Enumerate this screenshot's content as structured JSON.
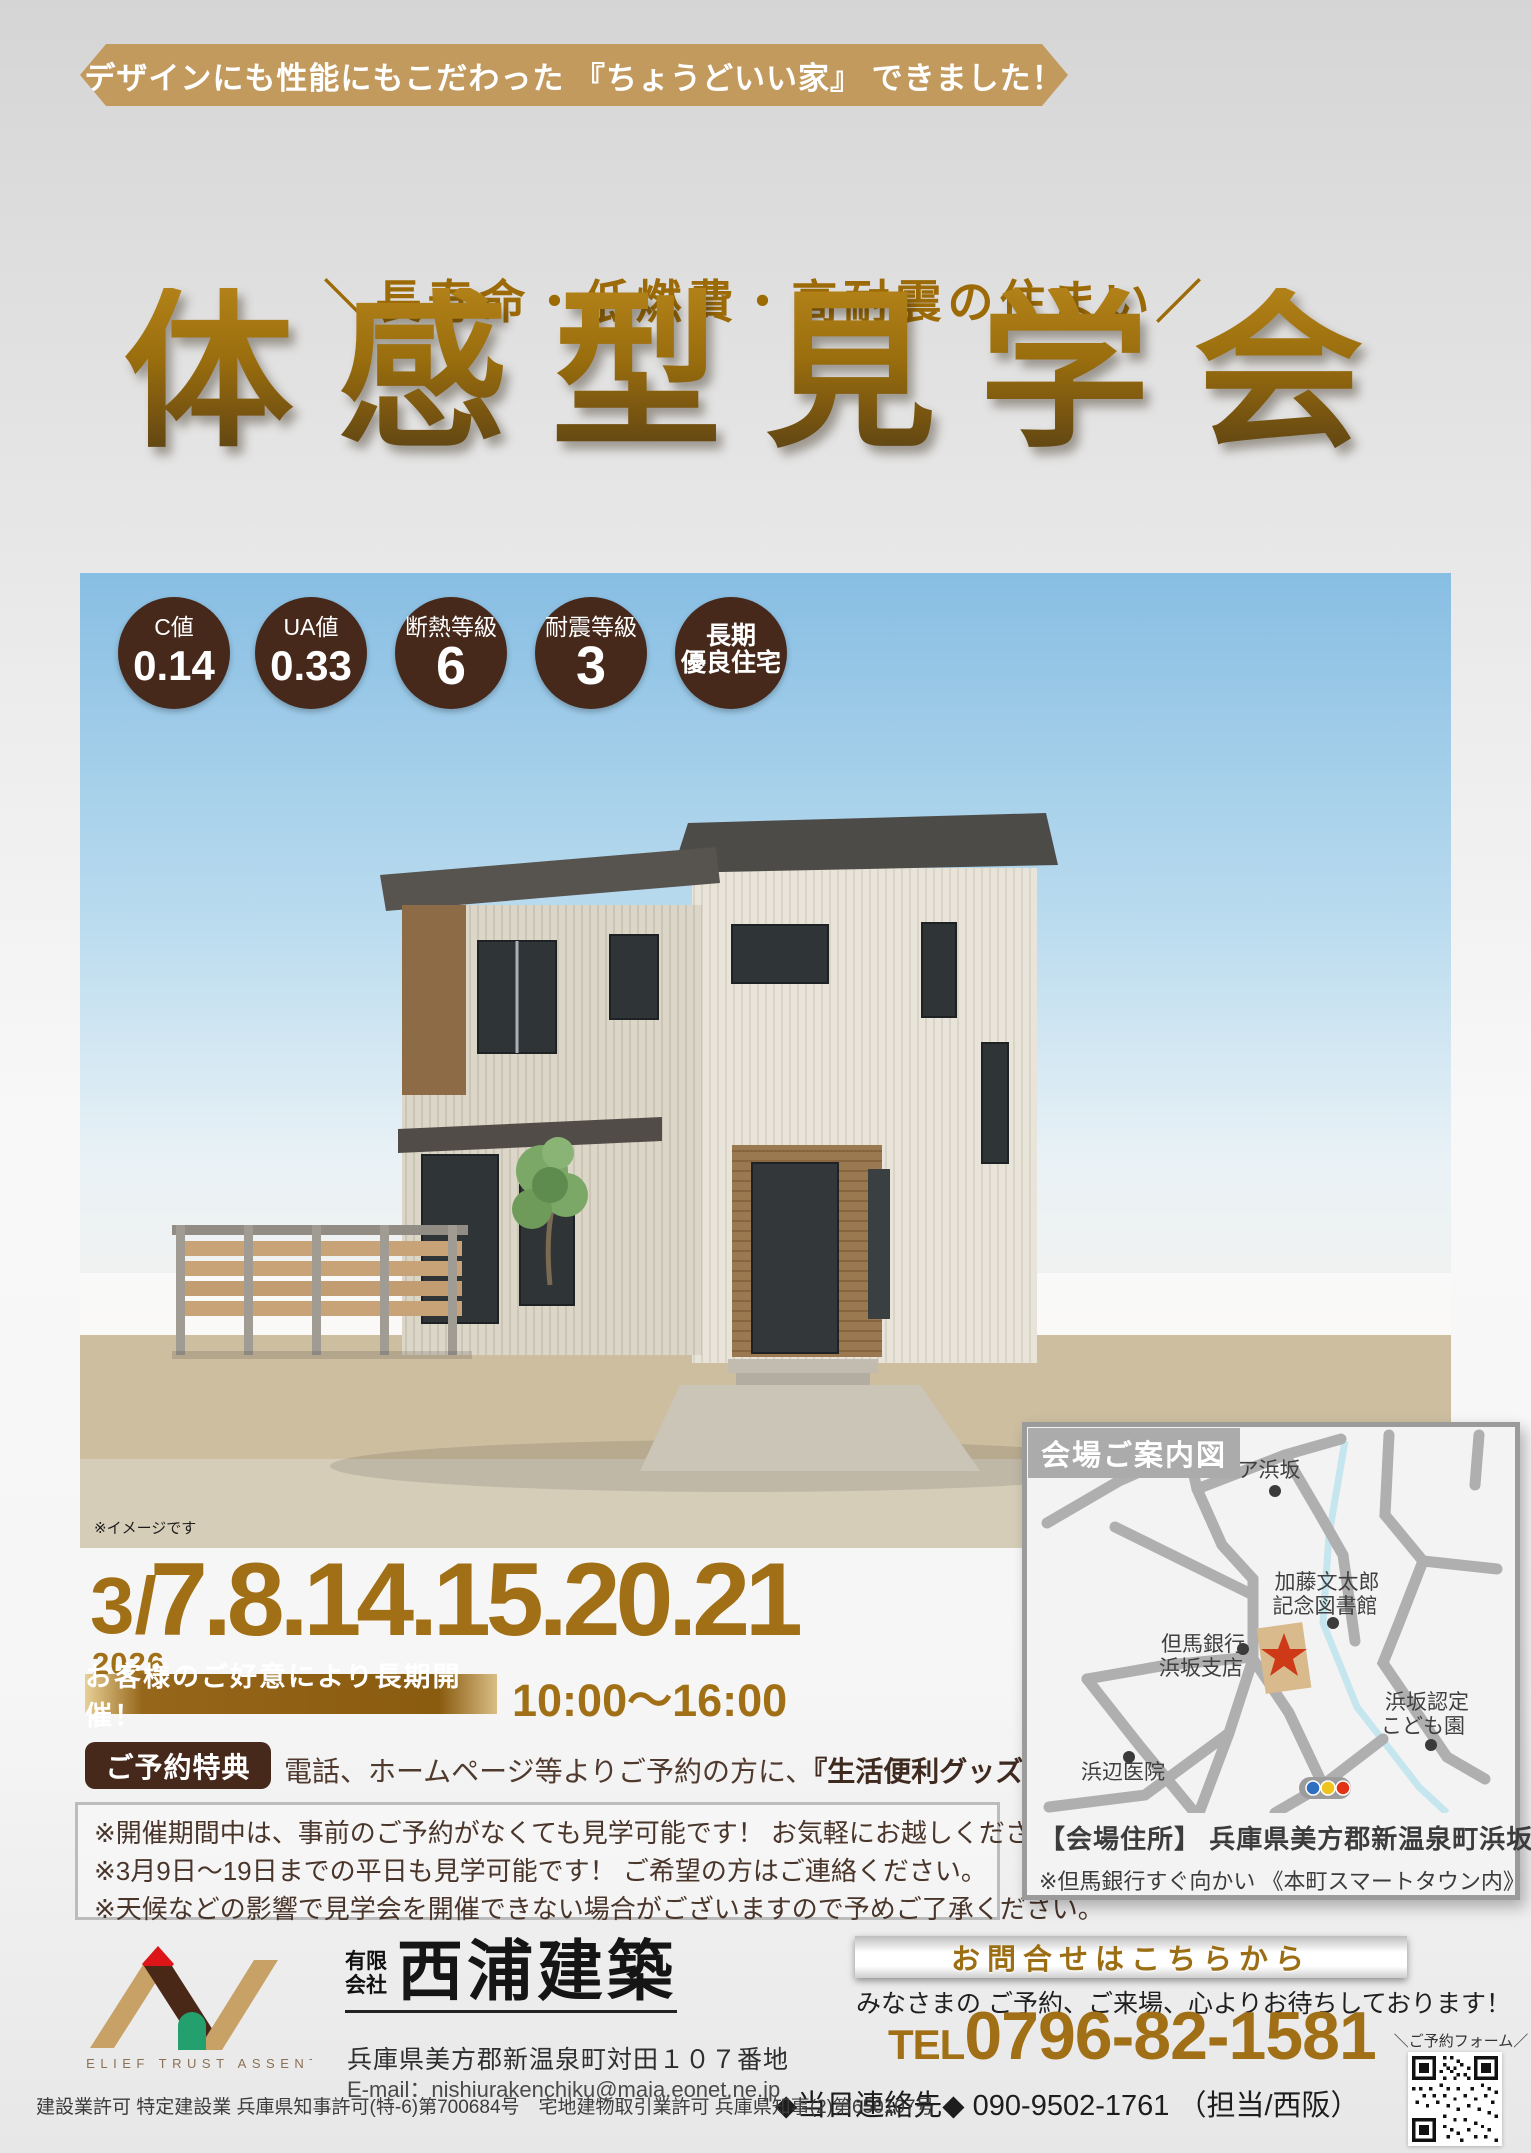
{
  "banner": {
    "text": "デザインにも性能にもこだわった 『ちょうどいい家』 できました！"
  },
  "slogan": {
    "text": "＼長寿命・低燃費・高耐震の住まい／"
  },
  "title": {
    "text": "体感型見学会"
  },
  "badges": [
    {
      "label": "C値",
      "value": "0.14"
    },
    {
      "label": "UA値",
      "value": "0.33"
    },
    {
      "label": "断熱等級",
      "value": "6"
    },
    {
      "label": "耐震等級",
      "value": "3"
    },
    {
      "label": "長期",
      "value": "優良住宅"
    }
  ],
  "photo": {
    "caption": "※イメージです"
  },
  "schedule": {
    "month": "3/",
    "year": "2026",
    "days": "7.8.14.15.20.21",
    "banner": "お客様のご好意により長期開催！",
    "time": "10:00〜16:00"
  },
  "reservation": {
    "badge": "ご予約特典",
    "text_pre": "電話、ホームページ等よりご予約の方に、",
    "highlight": "『生活便利グッズ』",
    "text_post": "をプレゼント！"
  },
  "notes": [
    "※開催期間中は、事前のご予約がなくても見学可能です！ お気軽にお越しください。",
    "※3月9日〜19日までの平日も見学可能です！ ご希望の方はご連絡ください。",
    "※天候などの影響で見学会を開催できない場合がございますので予めご了承ください。"
  ],
  "map": {
    "header": "会場ご案内図",
    "labels": {
      "utopia": "ユートピア浜坂",
      "kato1": "加藤文太郎",
      "kato2": "記念図書館",
      "bank1": "但馬銀行",
      "bank2": "浜坂支店",
      "kodomo1": "浜坂認定",
      "kodomo2": "こども園",
      "clinic": "浜辺医院"
    },
    "address_label": "【会場住所】",
    "address": "兵庫県美方郡新温泉町浜坂",
    "address_note": "※但馬銀行すぐ向かい 《本町スマートタウン内》"
  },
  "footer": {
    "logo_text": "RELIEF TRUST ASSENT",
    "company_prefix1": "有限",
    "company_prefix2": "会社",
    "company_name": "西浦建築",
    "company_address": "兵庫県美方郡新温泉町対田１０７番地",
    "company_email": "E-mail：nishiurakenchiku@maia.eonet.ne.jp",
    "contact_header": "お問合せはこちらから",
    "contact_message": "みなさまの ご予約、ご来場、心よりお待ちしております！",
    "tel_prefix": "TEL",
    "tel_number": "0796-82-1581",
    "day_contact": "◆当日連絡先◆ 090-9502-1761 （担当/西阪）",
    "qr_label": "＼ご予約フォーム／",
    "license": "建設業許可 特定建設業 兵庫県知事許可(特-6)第700684号　宅地建物取引業許可 兵庫県知事(2)第650107号"
  },
  "colors": {
    "ribbon_gold": "#C39A5E",
    "title_gold": "#9A6E0E",
    "accent_gold": "#A06F16",
    "badge_brown": "#47291C",
    "map_road_gray": "#AFAFAF",
    "venue_star_red": "#CE3A17"
  }
}
